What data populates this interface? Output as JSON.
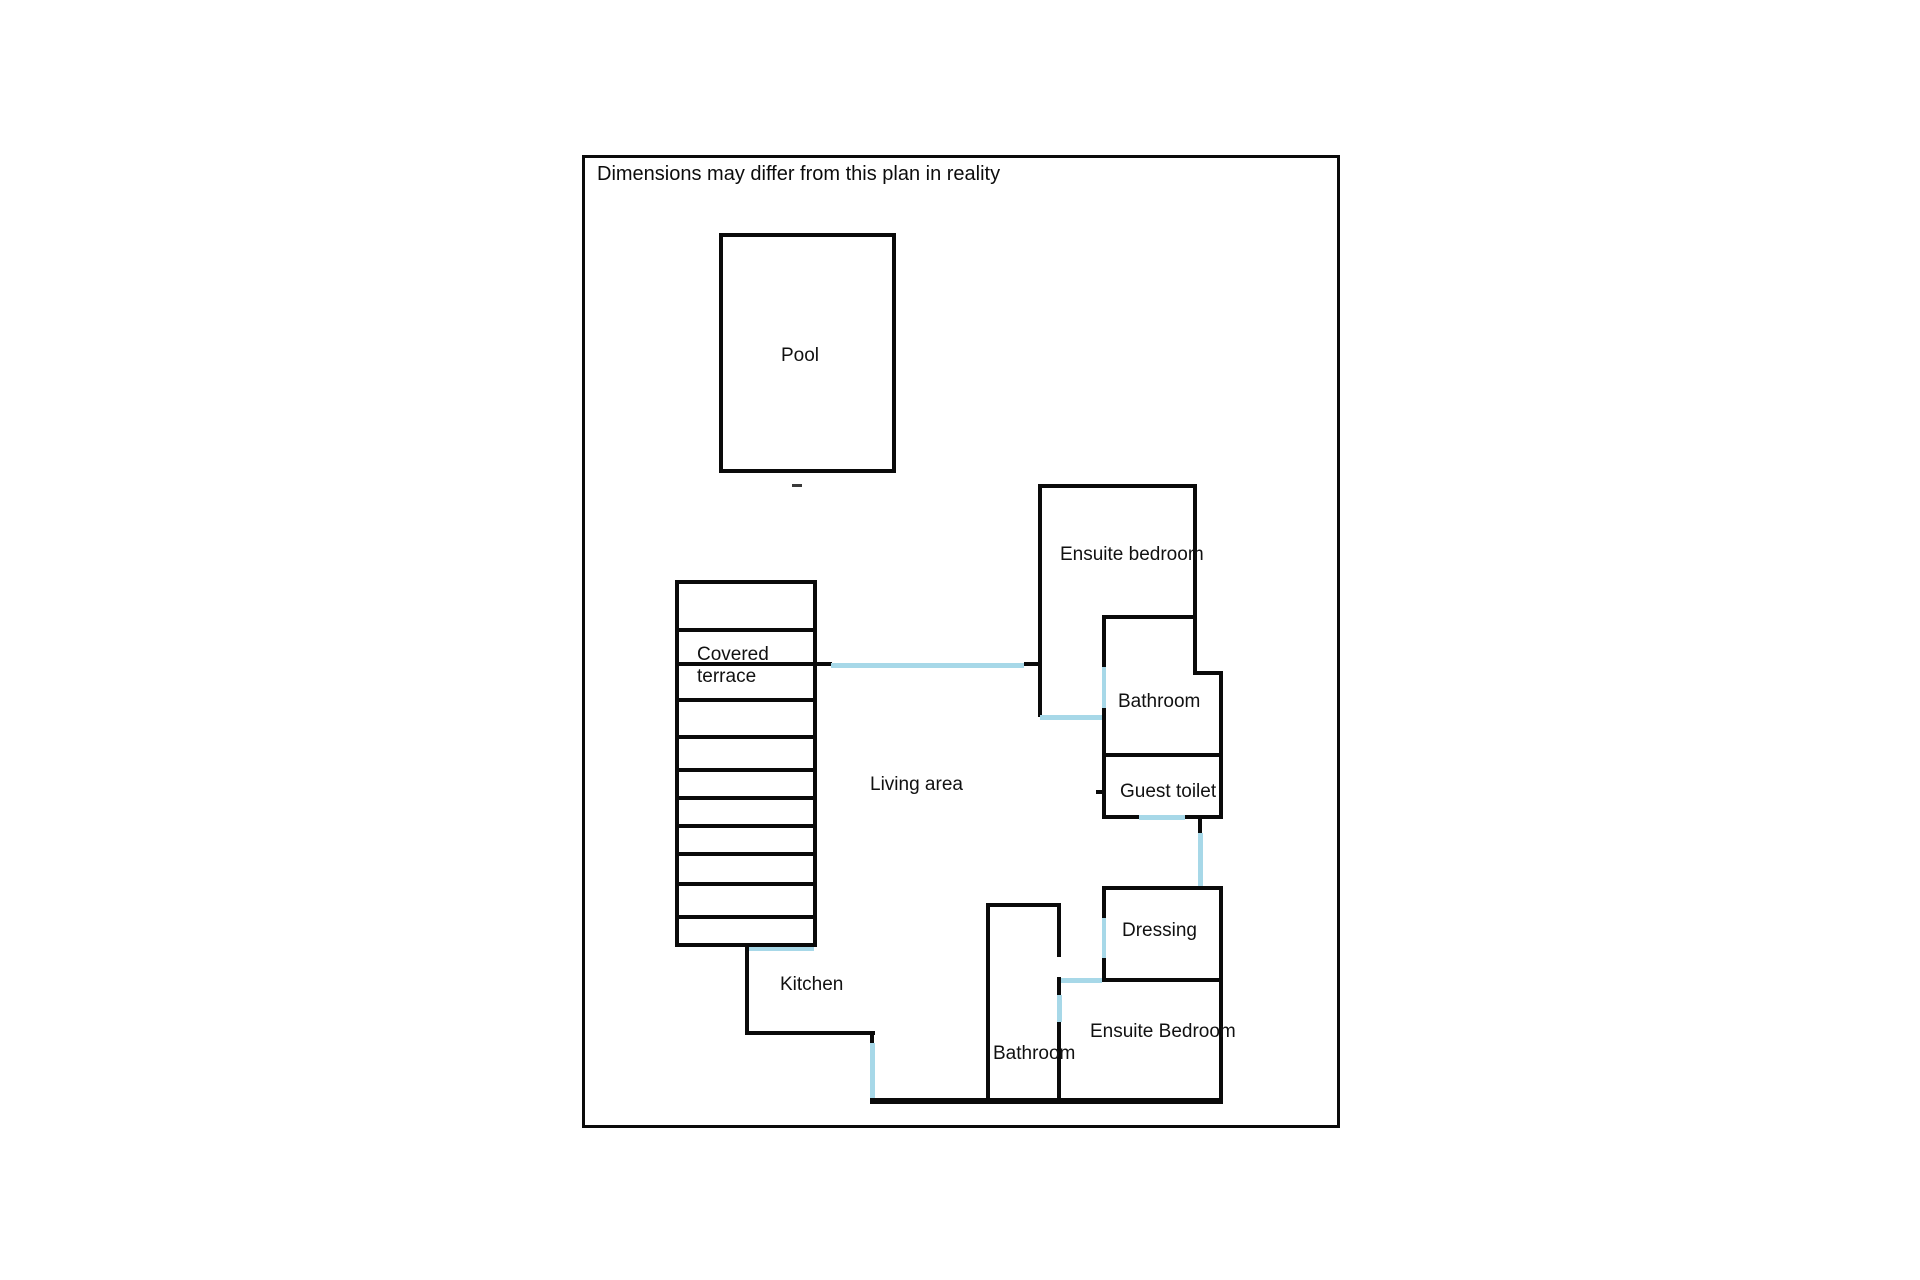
{
  "plan": {
    "disclaimer": "Dimensions may differ from this plan in reality",
    "colors": {
      "wall": "#0a0a0a",
      "opening": "#a7d8e8",
      "background": "#ffffff",
      "text": "#111111"
    },
    "rooms": {
      "pool": {
        "label": "Pool"
      },
      "covered_terrace": {
        "label_line1": "Covered",
        "label_line2": "terrace"
      },
      "living_area": {
        "label": "Living area"
      },
      "ensuite_bedroom_upper": {
        "label": "Ensuite bedroom"
      },
      "bathroom_upper": {
        "label": "Bathroom"
      },
      "guest_toilet": {
        "label": "Guest toilet"
      },
      "dressing": {
        "label": "Dressing"
      },
      "kitchen": {
        "label": "Kitchen"
      },
      "bathroom_lower": {
        "label": "Bathroom"
      },
      "ensuite_bedroom_lower": {
        "label": "Ensuite Bedroom"
      }
    }
  }
}
